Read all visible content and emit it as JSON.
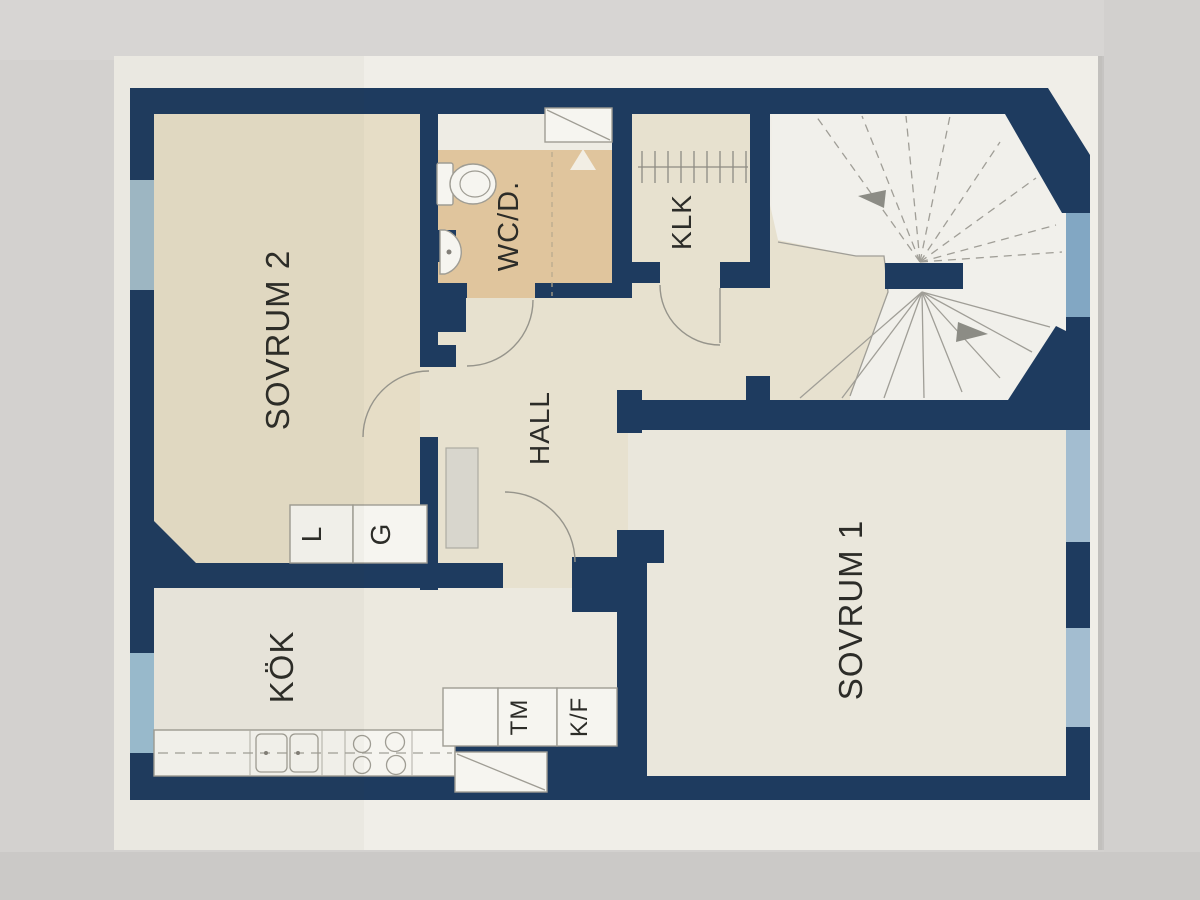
{
  "plan": {
    "type": "apartment-floor-plan-photo",
    "labels": {
      "sovrum2": "SOVRUM 2",
      "wcd": "WC/D.",
      "klk": "KLK",
      "hall": "HALL",
      "sovrum1": "SOVRUM 1",
      "kok": "KÖK",
      "l": "L",
      "g": "G",
      "tm": "TM",
      "kf": "K/F"
    },
    "colors": {
      "wall_navy": "#1c3a60",
      "paper": "#f5f3ee",
      "photo_background": "#d3d1cf",
      "floor_beige": "#ebe2cb",
      "floor_hall": "#ece6d4",
      "floor_light": "#f1eee5",
      "wet_room_tan": "#e5c9a0",
      "window_dusty_blue": "#a3bdcc",
      "window_light_blue": "#9dc1d6",
      "window_stair_blue": "#84aac8",
      "window_bedroom_blue": "#a6c1d5",
      "label_text": "#2b2b28"
    },
    "icons": [
      "toilet-icon",
      "sink-icon",
      "shower-icon",
      "drain-triangle-icon",
      "kitchen-sink-icon",
      "stove-icon",
      "wardrobe-rail-icon",
      "stairs-up-arrow-icon",
      "stairs-down-arrow-icon"
    ]
  }
}
